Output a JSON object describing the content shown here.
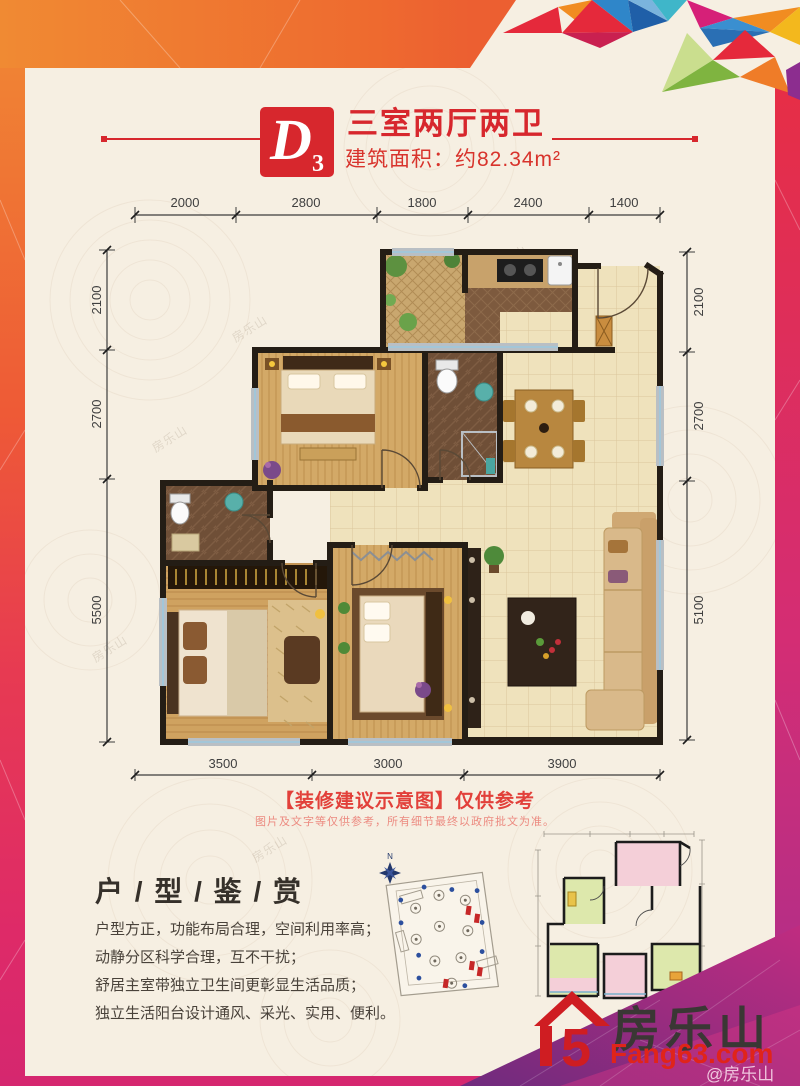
{
  "poster": {
    "watermark": "房乐山",
    "handle": "@房乐山"
  },
  "header": {
    "unit_letter": "D",
    "unit_number": "3",
    "title": "三室两厅两卫",
    "area": "建筑面积：约82.34m²"
  },
  "dimensions": {
    "top": [
      "2000",
      "2800",
      "1800",
      "2400",
      "1400"
    ],
    "bottom": [
      "3500",
      "3000",
      "3900"
    ],
    "left": [
      "2100",
      "2700",
      "5500"
    ],
    "right": [
      "2100",
      "2700",
      "5100"
    ]
  },
  "disclaimer": {
    "title": "【装修建议示意图】仅供参考",
    "note": "图片及文字等仅供参考，所有细节最终以政府批文为准。"
  },
  "appreciation": {
    "title": "户 / 型 / 鉴 / 赏",
    "points": [
      "户型方正，功能布局合理，空间利用率高；",
      "动静分区科学合理，互不干扰；",
      "舒居主室带独立卫生间更彰显生活品质；",
      "独立生活阳台设计通风、采光、实用、便利。"
    ]
  },
  "site_plan": {
    "north_label": "N"
  },
  "logo": {
    "icon_glyph": "5",
    "name": "房乐山",
    "domain": "Fang63.com"
  },
  "colors": {
    "accent_red": "#d7272d",
    "orange": "#ef7c2e",
    "magenta": "#d5276f",
    "purple": "#7c2a84",
    "logo_red": "#cf1d22",
    "text_dark": "#3a3734"
  }
}
